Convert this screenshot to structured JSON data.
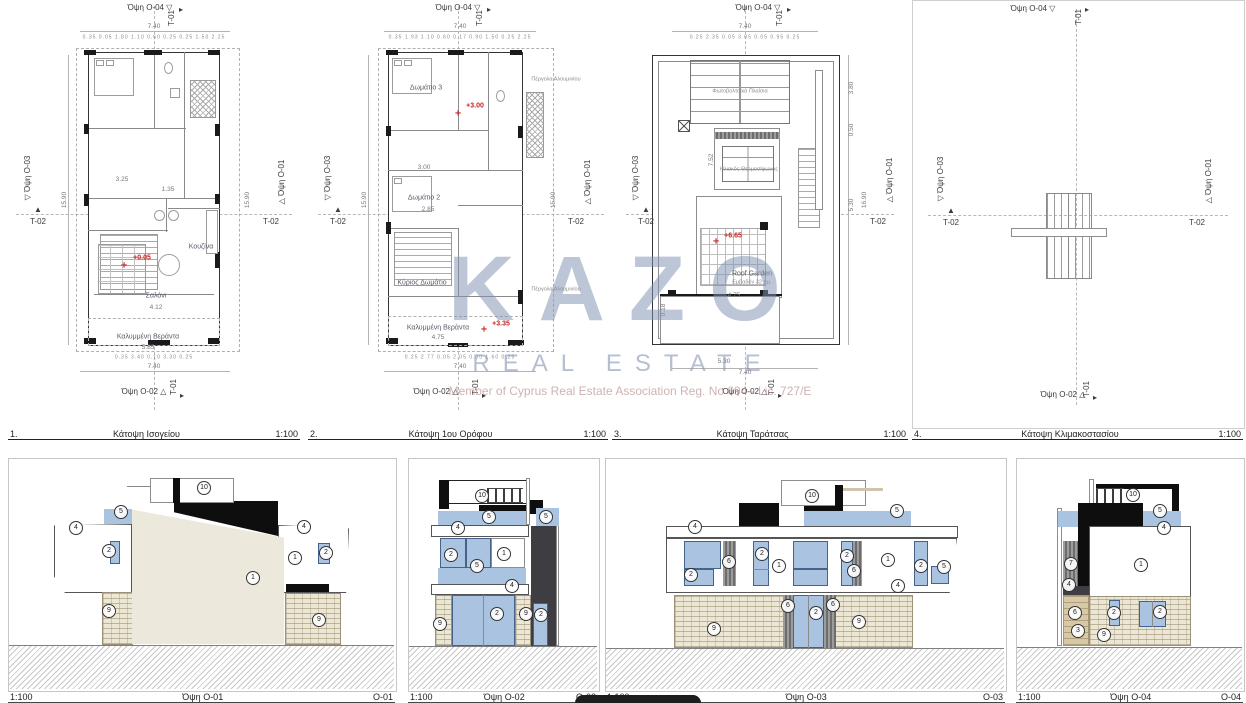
{
  "watermark": {
    "logo": "KAZO",
    "subtitle": "REAL ESTATE",
    "membership": "Member of Cyprus Real Estate Association    Reg. No 694 - Lic. 727/E"
  },
  "colors": {
    "accent_blue": "#a9c3e1",
    "stone": "#ece6d5",
    "cream_wall": "#ece9dc",
    "black": "#0e0e0e",
    "dark_slab": "#3e3e42",
    "tan": "#d7c9a8",
    "level_red": "#c22222",
    "watermark_blue": "#8091b2"
  },
  "plan_titles": [
    {
      "num": "1.",
      "title": "Κάτοψη Ισογείου",
      "scale": "1:100"
    },
    {
      "num": "2.",
      "title": "Κάτοψη 1ου Ορόφου",
      "scale": "1:100"
    },
    {
      "num": "3.",
      "title": "Κάτοψη Ταράτσας",
      "scale": "1:100"
    },
    {
      "num": "4.",
      "title": "Κάτοψη Κλιμακοστασίου",
      "scale": "1:100"
    }
  ],
  "elev_titles": [
    {
      "scale": "1:100",
      "title": "Όψη O-01",
      "code": "O-01"
    },
    {
      "scale": "1:100",
      "title": "Όψη O-02",
      "code": "O-02"
    },
    {
      "scale": "1:100",
      "title": "Όψη O-03",
      "code": "O-03"
    },
    {
      "scale": "1:100",
      "title": "Όψη O-04",
      "code": "O-04"
    }
  ],
  "plan_annotations": {
    "p1": [
      {
        "t": "Όψη O-04 ▽",
        "x": 142,
        "y": 8,
        "c": "mk"
      },
      {
        "t": "T-01",
        "x": 164,
        "y": 18,
        "c": "mk r"
      },
      {
        "t": "▸",
        "x": 173,
        "y": 10,
        "c": "mk"
      },
      {
        "t": "7.40",
        "x": 146,
        "y": 27,
        "c": "dim"
      },
      {
        "t": "0.35 0.05 1.80 1.10 0.60 0.25 0.25 1.50 2.25",
        "x": 146,
        "y": 38,
        "c": "sub"
      },
      {
        "t": "▽ Όψη O-03",
        "x": 20,
        "y": 178,
        "c": "mk r"
      },
      {
        "t": "▲",
        "x": 30,
        "y": 210,
        "c": "mk"
      },
      {
        "t": "T-02",
        "x": 30,
        "y": 222,
        "c": "mk"
      },
      {
        "t": "15.90",
        "x": 57,
        "y": 200,
        "c": "dim r"
      },
      {
        "t": "△ Όψη O-01",
        "x": 274,
        "y": 182,
        "c": "mk r"
      },
      {
        "t": "T-02",
        "x": 263,
        "y": 222,
        "c": "mk"
      },
      {
        "t": "15.90",
        "x": 240,
        "y": 200,
        "c": "dim r"
      },
      {
        "t": "3.25",
        "x": 114,
        "y": 180,
        "c": "dim"
      },
      {
        "t": "1.35",
        "x": 160,
        "y": 190,
        "c": "dim"
      },
      {
        "t": "Κουζίνα",
        "x": 193,
        "y": 247,
        "c": "room"
      },
      {
        "t": "✛",
        "x": 116,
        "y": 266,
        "c": "red"
      },
      {
        "t": "+0.05",
        "x": 134,
        "y": 258,
        "c": "red"
      },
      {
        "t": "Σαλόνι",
        "x": 148,
        "y": 296,
        "c": "room"
      },
      {
        "t": "4.12",
        "x": 148,
        "y": 308,
        "c": "dim"
      },
      {
        "t": "Καλυμμένη Βεράντα",
        "x": 140,
        "y": 337,
        "c": "room"
      },
      {
        "t": "5.85",
        "x": 140,
        "y": 348,
        "c": "dim"
      },
      {
        "t": "0.35 3.40 0.10 3.30 0.25",
        "x": 146,
        "y": 358,
        "c": "sub"
      },
      {
        "t": "7.40",
        "x": 146,
        "y": 367,
        "c": "dim"
      },
      {
        "t": "Όψη O-02 △",
        "x": 136,
        "y": 392,
        "c": "mk"
      },
      {
        "t": "T-01",
        "x": 166,
        "y": 387,
        "c": "mk r"
      },
      {
        "t": "▸",
        "x": 174,
        "y": 396,
        "c": "mk"
      }
    ],
    "p2": [
      {
        "t": "Όψη O-04 ▽",
        "x": 150,
        "y": 8,
        "c": "mk"
      },
      {
        "t": "T-01",
        "x": 172,
        "y": 18,
        "c": "mk r"
      },
      {
        "t": "▸",
        "x": 181,
        "y": 10,
        "c": "mk"
      },
      {
        "t": "7.40",
        "x": 152,
        "y": 27,
        "c": "dim"
      },
      {
        "t": "0.35 1.93 1.10 0.60 0.17 0.90 1.50 0.25 2.25",
        "x": 152,
        "y": 38,
        "c": "sub"
      },
      {
        "t": "▽ Όψη O-03",
        "x": 20,
        "y": 178,
        "c": "mk r"
      },
      {
        "t": "▲",
        "x": 30,
        "y": 210,
        "c": "mk"
      },
      {
        "t": "T-02",
        "x": 30,
        "y": 222,
        "c": "mk"
      },
      {
        "t": "15.90",
        "x": 57,
        "y": 200,
        "c": "dim r"
      },
      {
        "t": "△ Όψη O-01",
        "x": 280,
        "y": 182,
        "c": "mk r"
      },
      {
        "t": "T-02",
        "x": 268,
        "y": 222,
        "c": "mk"
      },
      {
        "t": "15.90",
        "x": 246,
        "y": 200,
        "c": "dim r"
      },
      {
        "t": "Δωμάτιο 3",
        "x": 118,
        "y": 88,
        "c": "room"
      },
      {
        "t": "3.00",
        "x": 116,
        "y": 168,
        "c": "dim"
      },
      {
        "t": "✛",
        "x": 150,
        "y": 114,
        "c": "red"
      },
      {
        "t": "+3.00",
        "x": 167,
        "y": 106,
        "c": "red"
      },
      {
        "t": "Πέργολα Αλουμινίου",
        "x": 248,
        "y": 80,
        "c": "note"
      },
      {
        "t": "Δωμάτιο 2",
        "x": 116,
        "y": 198,
        "c": "room"
      },
      {
        "t": "2.85",
        "x": 120,
        "y": 210,
        "c": "dim"
      },
      {
        "t": "Κύριος Δωμάτιο",
        "x": 114,
        "y": 283,
        "c": "room"
      },
      {
        "t": "Πέργολα Αλουμινίου",
        "x": 248,
        "y": 290,
        "c": "note"
      },
      {
        "t": "Καλυμμένη Βεράντα",
        "x": 130,
        "y": 328,
        "c": "room"
      },
      {
        "t": "4.75",
        "x": 130,
        "y": 338,
        "c": "dim"
      },
      {
        "t": "✛",
        "x": 176,
        "y": 330,
        "c": "red"
      },
      {
        "t": "+3.35",
        "x": 193,
        "y": 324,
        "c": "red"
      },
      {
        "t": "0.25 2.77 0.05 2.05 0.30 1.60 0.25",
        "x": 152,
        "y": 358,
        "c": "sub"
      },
      {
        "t": "7.40",
        "x": 152,
        "y": 367,
        "c": "dim"
      },
      {
        "t": "Όψη O-02 △",
        "x": 128,
        "y": 392,
        "c": "mk"
      },
      {
        "t": "T-01",
        "x": 168,
        "y": 387,
        "c": "mk r"
      },
      {
        "t": "▸",
        "x": 176,
        "y": 396,
        "c": "mk"
      }
    ],
    "p3": [
      {
        "t": "Όψη O-04 ▽",
        "x": 146,
        "y": 8,
        "c": "mk"
      },
      {
        "t": "T-01",
        "x": 168,
        "y": 18,
        "c": "mk r"
      },
      {
        "t": "▸",
        "x": 177,
        "y": 10,
        "c": "mk"
      },
      {
        "t": "7.40",
        "x": 133,
        "y": 27,
        "c": "dim"
      },
      {
        "t": "0.25 2.35 0.05 3.05 0.05 0.95 0.25",
        "x": 133,
        "y": 38,
        "c": "sub"
      },
      {
        "t": "▽ Όψη O-03",
        "x": 24,
        "y": 178,
        "c": "mk r"
      },
      {
        "t": "▲",
        "x": 34,
        "y": 210,
        "c": "mk"
      },
      {
        "t": "T-02",
        "x": 34,
        "y": 222,
        "c": "mk"
      },
      {
        "t": "△ Όψη O-01",
        "x": 278,
        "y": 180,
        "c": "mk r"
      },
      {
        "t": "T-02",
        "x": 266,
        "y": 222,
        "c": "mk"
      },
      {
        "t": "3.80",
        "x": 240,
        "y": 88,
        "c": "dim r"
      },
      {
        "t": "0.50",
        "x": 240,
        "y": 130,
        "c": "dim r"
      },
      {
        "t": "5.30",
        "x": 240,
        "y": 205,
        "c": "dim r"
      },
      {
        "t": "16.90",
        "x": 253,
        "y": 200,
        "c": "dim r"
      },
      {
        "t": "Φωτοβολταϊκά Πλαίσια",
        "x": 128,
        "y": 92,
        "c": "note"
      },
      {
        "t": "Ηλιακός Θερμοσίφωνας",
        "x": 137,
        "y": 170,
        "c": "note"
      },
      {
        "t": "7.52",
        "x": 100,
        "y": 160,
        "c": "dim r"
      },
      {
        "t": "✛",
        "x": 104,
        "y": 242,
        "c": "red"
      },
      {
        "t": "+6.65",
        "x": 121,
        "y": 236,
        "c": "red"
      },
      {
        "t": "Roof Garden",
        "x": 140,
        "y": 274,
        "c": "room"
      },
      {
        "t": "Εμβαδόν 32 τ.μ.",
        "x": 140,
        "y": 283,
        "c": "note"
      },
      {
        "t": "4.75",
        "x": 122,
        "y": 296,
        "c": "dim"
      },
      {
        "t": "0.18",
        "x": 52,
        "y": 310,
        "c": "dim r"
      },
      {
        "t": "5.30",
        "x": 112,
        "y": 362,
        "c": "dim"
      },
      {
        "t": "7.40",
        "x": 133,
        "y": 373,
        "c": "dim"
      },
      {
        "t": "Όψη O-02 △",
        "x": 133,
        "y": 392,
        "c": "mk"
      },
      {
        "t": "T-01",
        "x": 160,
        "y": 387,
        "c": "mk r"
      },
      {
        "t": "▸",
        "x": 168,
        "y": 396,
        "c": "mk"
      }
    ],
    "p4": [
      {
        "t": "Όψη O-04 ▽",
        "x": 120,
        "y": 8,
        "c": "mk"
      },
      {
        "t": "T-01",
        "x": 166,
        "y": 16,
        "c": "mk r"
      },
      {
        "t": "▸",
        "x": 174,
        "y": 9,
        "c": "mk"
      },
      {
        "t": "▽ Όψη O-03",
        "x": 28,
        "y": 178,
        "c": "mk r"
      },
      {
        "t": "▲",
        "x": 38,
        "y": 210,
        "c": "mk"
      },
      {
        "t": "T-02",
        "x": 38,
        "y": 222,
        "c": "mk"
      },
      {
        "t": "△ Όψη O-01",
        "x": 296,
        "y": 180,
        "c": "mk r"
      },
      {
        "t": "T-02",
        "x": 284,
        "y": 222,
        "c": "mk"
      },
      {
        "t": "Όψη O-02 △",
        "x": 150,
        "y": 394,
        "c": "mk"
      },
      {
        "t": "T-01",
        "x": 174,
        "y": 388,
        "c": "mk r"
      },
      {
        "t": "▸",
        "x": 182,
        "y": 397,
        "c": "mk"
      }
    ]
  },
  "elev_annotations": {
    "e1": [
      {
        "t": "10",
        "x": 195,
        "y": 29,
        "c": "badge"
      },
      {
        "t": "5",
        "x": 112,
        "y": 53,
        "c": "badge"
      },
      {
        "t": "4",
        "x": 67,
        "y": 69,
        "c": "badge"
      },
      {
        "t": "4",
        "x": 295,
        "y": 68,
        "c": "badge"
      },
      {
        "t": "2",
        "x": 100,
        "y": 92,
        "c": "badge"
      },
      {
        "t": "1",
        "x": 244,
        "y": 119,
        "c": "badge"
      },
      {
        "t": "1",
        "x": 286,
        "y": 99,
        "c": "badge"
      },
      {
        "t": "2",
        "x": 317,
        "y": 94,
        "c": "badge"
      },
      {
        "t": "9",
        "x": 100,
        "y": 152,
        "c": "badge"
      },
      {
        "t": "9",
        "x": 310,
        "y": 161,
        "c": "badge"
      }
    ],
    "e2": [
      {
        "t": "10",
        "x": 73,
        "y": 37,
        "c": "badge"
      },
      {
        "t": "5",
        "x": 80,
        "y": 58,
        "c": "badge"
      },
      {
        "t": "5",
        "x": 137,
        "y": 58,
        "c": "badge"
      },
      {
        "t": "4",
        "x": 49,
        "y": 69,
        "c": "badge"
      },
      {
        "t": "2",
        "x": 42,
        "y": 96,
        "c": "badge"
      },
      {
        "t": "1",
        "x": 95,
        "y": 95,
        "c": "badge"
      },
      {
        "t": "5",
        "x": 68,
        "y": 107,
        "c": "badge"
      },
      {
        "t": "4",
        "x": 103,
        "y": 127,
        "c": "badge"
      },
      {
        "t": "2",
        "x": 88,
        "y": 155,
        "c": "badge"
      },
      {
        "t": "2",
        "x": 132,
        "y": 156,
        "c": "badge"
      },
      {
        "t": "9",
        "x": 31,
        "y": 165,
        "c": "badge"
      },
      {
        "t": "9",
        "x": 117,
        "y": 155,
        "c": "badge"
      }
    ],
    "e3": [
      {
        "t": "10",
        "x": 206,
        "y": 37,
        "c": "badge"
      },
      {
        "t": "5",
        "x": 291,
        "y": 52,
        "c": "badge"
      },
      {
        "t": "4",
        "x": 89,
        "y": 68,
        "c": "badge"
      },
      {
        "t": "2",
        "x": 85,
        "y": 116,
        "c": "badge"
      },
      {
        "t": "6",
        "x": 123,
        "y": 103,
        "c": "badge"
      },
      {
        "t": "2",
        "x": 156,
        "y": 95,
        "c": "badge"
      },
      {
        "t": "1",
        "x": 173,
        "y": 107,
        "c": "badge"
      },
      {
        "t": "2",
        "x": 241,
        "y": 97,
        "c": "badge"
      },
      {
        "t": "6",
        "x": 248,
        "y": 112,
        "c": "badge"
      },
      {
        "t": "1",
        "x": 282,
        "y": 101,
        "c": "badge"
      },
      {
        "t": "2",
        "x": 315,
        "y": 107,
        "c": "badge"
      },
      {
        "t": "5",
        "x": 338,
        "y": 108,
        "c": "badge"
      },
      {
        "t": "4",
        "x": 292,
        "y": 127,
        "c": "badge"
      },
      {
        "t": "6",
        "x": 182,
        "y": 147,
        "c": "badge"
      },
      {
        "t": "2",
        "x": 210,
        "y": 154,
        "c": "badge"
      },
      {
        "t": "6",
        "x": 227,
        "y": 146,
        "c": "badge"
      },
      {
        "t": "9",
        "x": 108,
        "y": 170,
        "c": "badge"
      },
      {
        "t": "9",
        "x": 253,
        "y": 163,
        "c": "badge"
      }
    ],
    "e4": [
      {
        "t": "10",
        "x": 116,
        "y": 36,
        "c": "badge"
      },
      {
        "t": "5",
        "x": 143,
        "y": 52,
        "c": "badge"
      },
      {
        "t": "4",
        "x": 147,
        "y": 69,
        "c": "badge"
      },
      {
        "t": "1",
        "x": 124,
        "y": 106,
        "c": "badge"
      },
      {
        "t": "7",
        "x": 54,
        "y": 105,
        "c": "badge"
      },
      {
        "t": "4",
        "x": 52,
        "y": 126,
        "c": "badge"
      },
      {
        "t": "6",
        "x": 58,
        "y": 154,
        "c": "badge"
      },
      {
        "t": "3",
        "x": 61,
        "y": 172,
        "c": "badge"
      },
      {
        "t": "2",
        "x": 97,
        "y": 154,
        "c": "badge"
      },
      {
        "t": "2",
        "x": 143,
        "y": 153,
        "c": "badge"
      },
      {
        "t": "9",
        "x": 87,
        "y": 176,
        "c": "badge"
      }
    ]
  }
}
